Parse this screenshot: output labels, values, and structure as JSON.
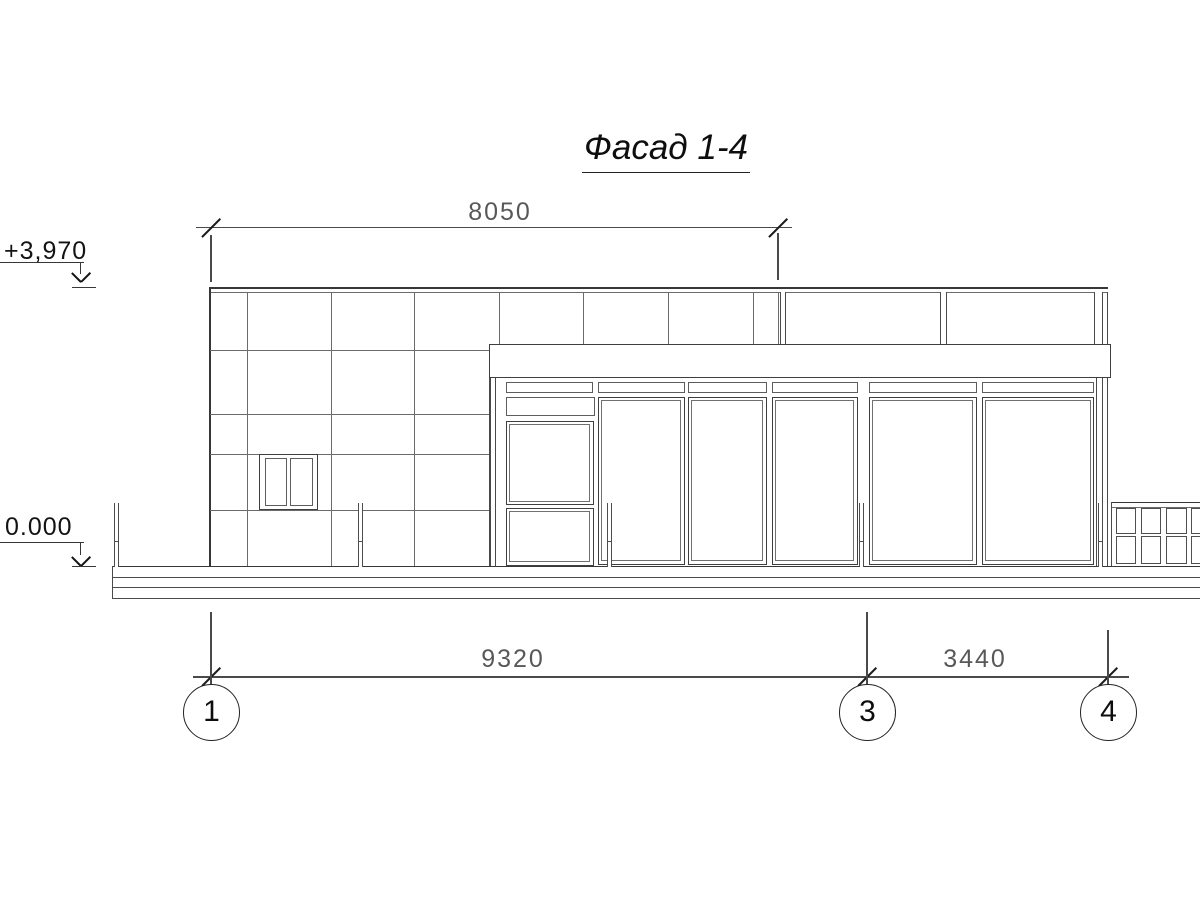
{
  "drawing": {
    "title": "Фасад 1-4",
    "elevation_marks": {
      "top": "+3,970",
      "ground": "0.000"
    },
    "dimensions": {
      "top_width": "8050",
      "bottom_left": "9320",
      "bottom_right": "3440"
    },
    "axes": {
      "a1": "1",
      "a3": "3",
      "a4": "4"
    },
    "colors": {
      "line": "#3f3f3f",
      "detail_line": "#6b6b6b",
      "dim_line": "#4a4a4a",
      "dim_text": "#585858",
      "text": "#131313",
      "background": "#ffffff"
    }
  }
}
